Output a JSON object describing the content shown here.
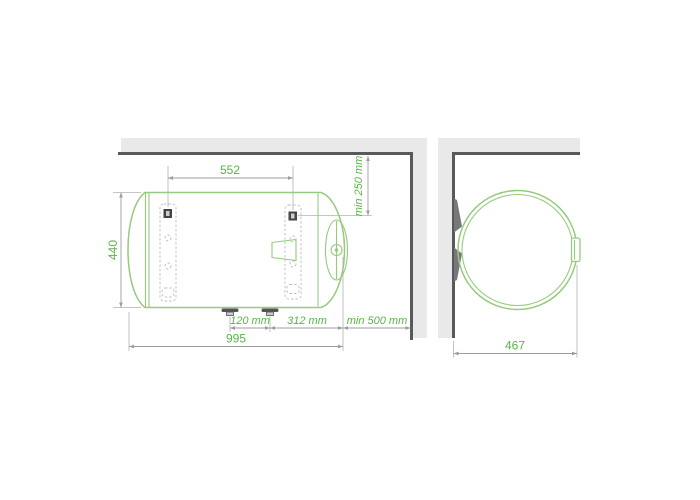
{
  "diagram": {
    "description": "horizontal water heater installation drawing with mounting clearances",
    "side_view": {
      "dimensions": {
        "anchor_spacing": "552",
        "ceiling_clearance": "min 250 mm",
        "height": "440",
        "pipe_spacing": "120 mm",
        "pipe_to_end": "312 mm",
        "wall_clearance": "min 500 mm",
        "total_length": "995"
      }
    },
    "front_view": {
      "dimensions": {
        "depth": "467"
      }
    }
  },
  "colors": {
    "outline_green": "#95cb7d",
    "label_green": "#56b747",
    "dimension_gray": "#9d9d9f",
    "witness_gray": "#b2b2b2",
    "wall_fill": "#e9e9e9",
    "wall_edge": "#58595b",
    "fitting_dark": "#545456",
    "background": "#ffffff"
  }
}
